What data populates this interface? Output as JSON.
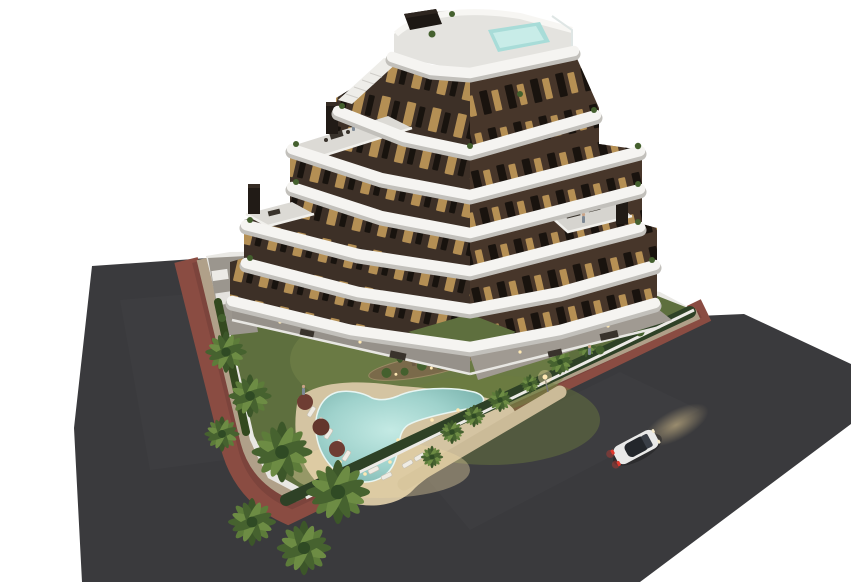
{
  "meta": {
    "description": "Aerial dusk 3D architectural rendering of a modern stepped apartment building with curved white wrap-around balconies, a rooftop plunge pool, landscaped garden with a free-form swimming pool, palm trees, perimeter hedge and walls, surrounding asphalt roads with a terracotta bike lane, and a white car driving with headlights on. Isolated on a white background.",
    "scene_type": "architectural-render"
  },
  "colors": {
    "background": "#ffffff",
    "asphalt": "#3a3a3d",
    "asphalt_light": "#47474a",
    "bike_lane": "#8a4c42",
    "sidewalk": "#b0a089",
    "wall_white": "#e9e8e4",
    "lawn": "#5e6f3e",
    "lawn_light": "#76864a",
    "hedge": "#2e4126",
    "deck_sand": "#d4c4a2",
    "deck_glow": "#ecd7a6",
    "pool_water": "#9fd2cc",
    "pool_water_light": "#c4eae4",
    "rooftop_pool": "#a8dcd8",
    "facade_left": "#3d3027",
    "facade_right": "#47362a",
    "window_lit": "#c9a05c",
    "window_dark": "#140f0b",
    "band_white": "#f5f4f1",
    "band_shadow": "#c2c0bb",
    "terrace_gray": "#dcdad5",
    "chimney": "#211b16",
    "palm_dark": "#46622f",
    "palm_light": "#5d7c3a",
    "umbrella": "#6e3d33",
    "car_body": "#e9e9e8",
    "car_glass": "#23262b",
    "taillight": "#e03a2e",
    "headlight_glow": "#dcc088"
  },
  "building": {
    "floors_visible": 7,
    "balcony_style": "curved white bands wrapping a chevron-shaped tower",
    "facade_material": "dark brown cladding with warm lit windows",
    "roof_terraces": 3,
    "chimneys": 3,
    "rooftop_features": [
      "plunge-pool",
      "solar-panel-unit",
      "stair-bulkhead",
      "glass-railing"
    ]
  },
  "garden": {
    "pool_shape": "free-form boomerang with underwater lights",
    "underwater_lights": 7,
    "sun_loungers": 9,
    "parasols": 3,
    "palm_trees": 15,
    "planting_island": 1,
    "perimeter": [
      "white wall",
      "dark hedge",
      "tan sidewalk",
      "terracotta bike lane"
    ]
  },
  "surroundings": {
    "roads": 2,
    "street_lamps": 1,
    "vehicle": {
      "type": "car",
      "color": "white",
      "state": "driving, headlights on, taillights lit"
    }
  }
}
